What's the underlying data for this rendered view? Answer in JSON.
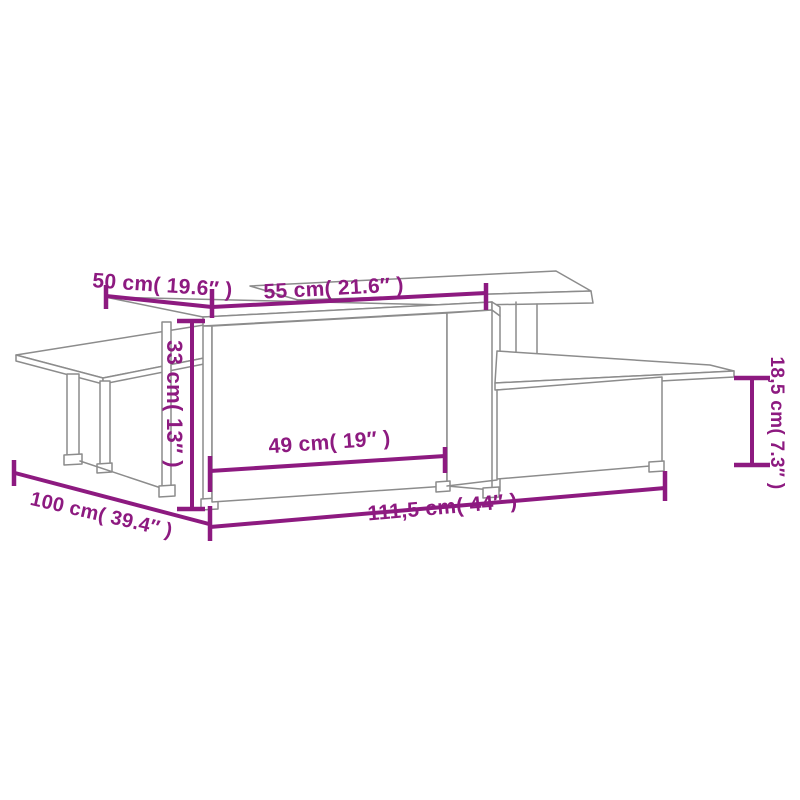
{
  "diagram": {
    "kind": "product-dimension-diagram",
    "subject": "Two interlocking tiered coffee tables (line drawing)",
    "colors": {
      "dimension": "#8d1a80",
      "outline": "#8c8c8c",
      "background": "#ffffff"
    },
    "dimensions": {
      "d50": {
        "label": "50 cm( 19.6″ )",
        "cm": "50",
        "inches": "19.6"
      },
      "d55": {
        "label": "55 cm( 21.6″ )",
        "cm": "55",
        "inches": "21.6"
      },
      "d33": {
        "label": "33 cm( 13″ )",
        "cm": "33",
        "inches": "13"
      },
      "d49": {
        "label": "49 cm( 19″ )",
        "cm": "49",
        "inches": "19"
      },
      "d111": {
        "label": "111,5 cm( 44″ )",
        "cm": "111,5",
        "inches": "44"
      },
      "d100": {
        "label": "100 cm( 39.4″ )",
        "cm": "100",
        "inches": "39.4"
      },
      "d18": {
        "label": "18,5 cm( 7.3″ )",
        "cm": "18,5",
        "inches": "7.3"
      }
    }
  }
}
